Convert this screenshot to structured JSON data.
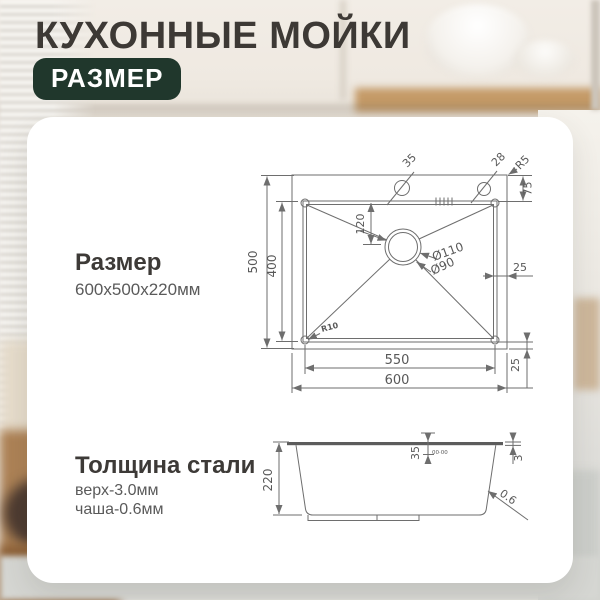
{
  "header": {
    "title": "КУХОННЫЕ МОЙКИ",
    "badge": "РАЗМЕР"
  },
  "sections": {
    "size": {
      "heading": "Размер",
      "value": "600x500x220мм"
    },
    "thickness": {
      "heading": "Толщина стали",
      "top": "верх-3.0мм",
      "bowl": "чаша-0.6мм"
    }
  },
  "top_view": {
    "outer_width": "600",
    "inner_width": "550",
    "outer_height": "500",
    "inner_height": "400",
    "drain_offset": "120",
    "drain_outer_dia": "Ø110",
    "drain_inner_dia": "Ø90",
    "corner_radius": "R10",
    "hole_left_dia": "35",
    "hole_right_dia": "28",
    "edge_radius": "R5",
    "top_margin": "75",
    "right_margin": "25",
    "bottom_margin": "25"
  },
  "side_view": {
    "depth": "220",
    "rim_depth": "35",
    "rim_thickness": "3",
    "bowl_thickness": "0.6",
    "overflow_marks": "00·00"
  },
  "colors": {
    "badge_bg": "#20372c",
    "title_text": "#3d3935",
    "drawing_line": "#6e6e6e",
    "card_bg": "#ffffff"
  }
}
